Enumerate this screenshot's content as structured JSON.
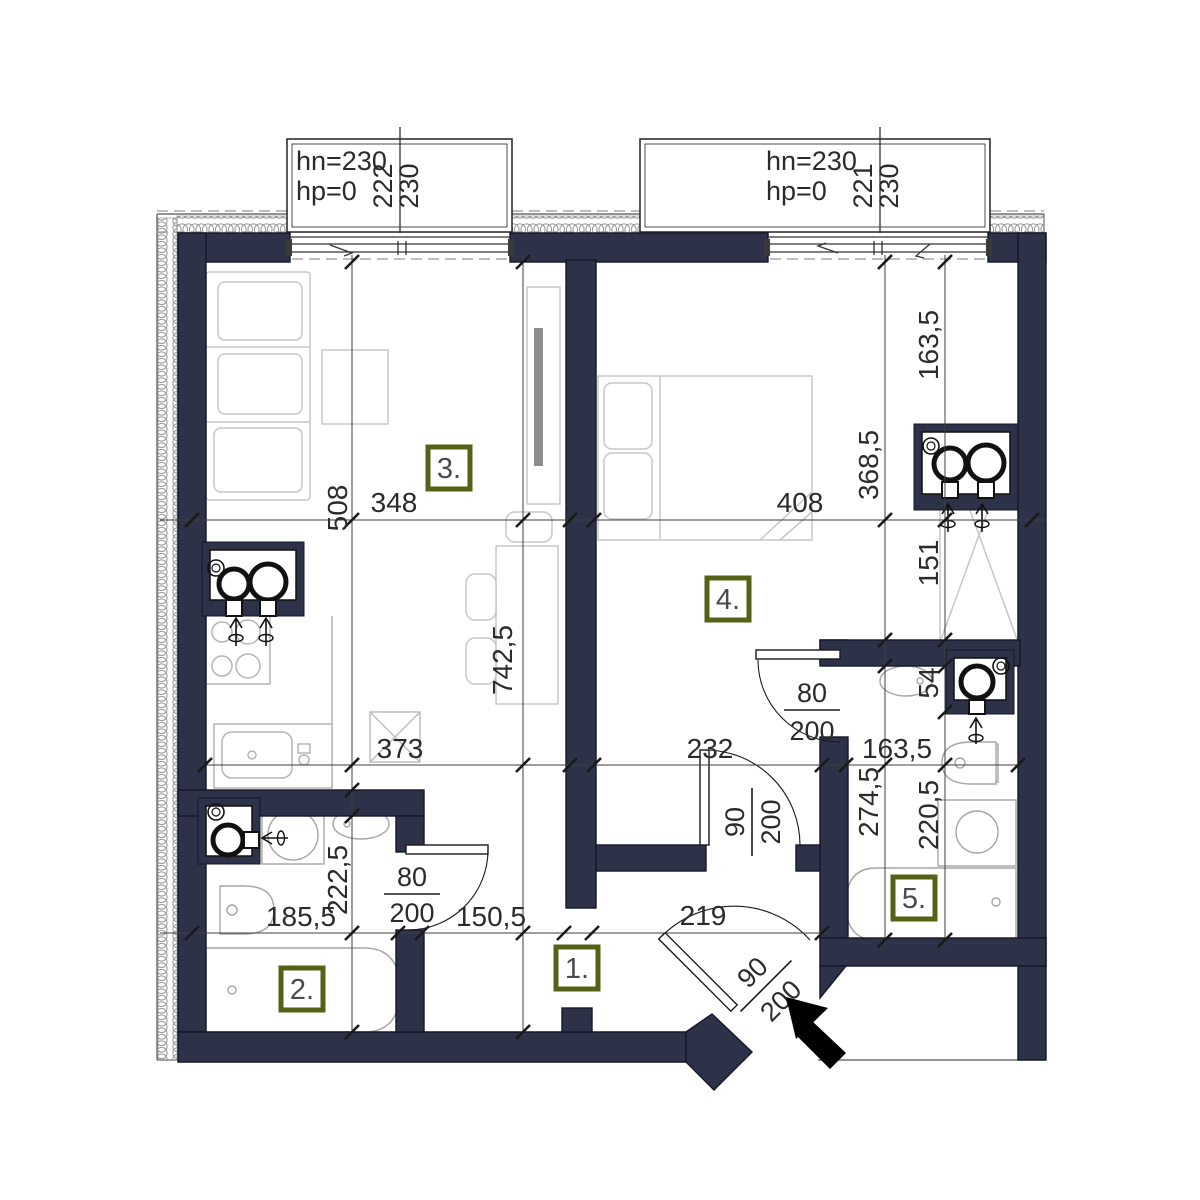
{
  "drawing_type": "apartment floor plan",
  "colors": {
    "wall": "#2d3248",
    "room_label_border": "#536216",
    "dim_text": "#2b2b2b",
    "furniture_line": "#c7c7c7",
    "fixture_line": "#a5a5a5"
  },
  "windows": [
    {
      "hn": "hn=230",
      "hp": "hp=0",
      "w": "222",
      "h": "230"
    },
    {
      "hn": "hn=230",
      "hp": "hp=0",
      "w": "221",
      "h": "230"
    }
  ],
  "rooms": [
    {
      "number": "1."
    },
    {
      "number": "2."
    },
    {
      "number": "3."
    },
    {
      "number": "4."
    },
    {
      "number": "5."
    }
  ],
  "dims": {
    "d508": "508",
    "d348": "348",
    "d408": "408",
    "d163_5_a": "163,5",
    "d368_5": "368,5",
    "d742_5": "742,5",
    "d151": "151",
    "d54": "54",
    "d373": "373",
    "d232": "232",
    "d163_5_b": "163,5",
    "d274_5": "274,5",
    "d220_5": "220,5",
    "d185_5": "185,5",
    "d222_5": "222,5",
    "d150_5": "150,5",
    "d219": "219"
  },
  "doors": {
    "bath_small": {
      "num": "80",
      "den": "200"
    },
    "bedroom": {
      "num": "90",
      "den": "200"
    },
    "bath_right": {
      "num": "80",
      "den": "200"
    },
    "entrance": {
      "num": "90",
      "den": "200"
    }
  }
}
